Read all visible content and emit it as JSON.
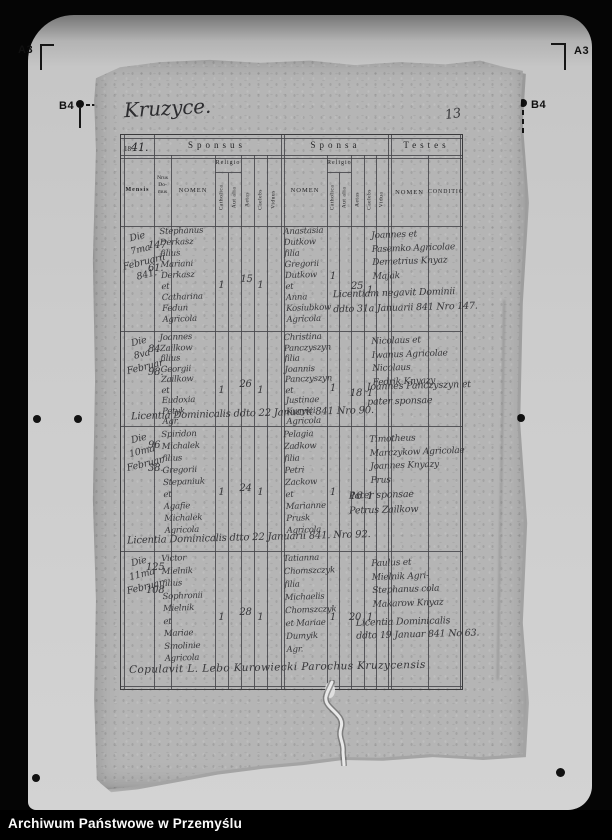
{
  "colors": {
    "background": "#000000",
    "platen": "#c9c9c9",
    "paper": "#b5b5b5",
    "ink": "#37373a",
    "caption_text": "#fbfbfb"
  },
  "fiducials": {
    "a3_left": "A3",
    "a3_right": "A3",
    "b4_left": "B4",
    "b4_right": "B4"
  },
  "caption": "Archiwum Państwowe w Przemyślu",
  "page": {
    "title_script": "Kruzyce.",
    "page_number": "13",
    "year_printed": "18",
    "year_hand": "41.",
    "header": {
      "sponsus": "Sponsus",
      "sponsa": "Sponsa",
      "testes": "Testes",
      "mensis": "Mensis",
      "nrus": [
        "Nrus",
        "Do-",
        "mus"
      ],
      "nomen": "NOMEN",
      "religio": "Religio",
      "catholica": "Catholica",
      "aut_alia": "Aut alia",
      "aetas": "Aetas",
      "caelebs": "Caelebs",
      "viduus": "Viduus",
      "vidua": "Vidua",
      "conditio": "CONDITIO"
    },
    "entries": [
      {
        "mensis": [
          "Die",
          "7ma",
          "Februarii",
          "841."
        ],
        "nrus": [
          "147",
          "61."
        ],
        "sponsus_nomen": [
          "Stephanus",
          "Derkasz",
          "filius",
          "Mariani",
          "Derkasz",
          "et",
          "Catharina",
          "Fedun",
          "Agricola"
        ],
        "sponsus_catholica": "1",
        "sponsus_aetas": "15",
        "sponsus_caelebs": "1",
        "sponsa_nomen": [
          "Anastasia",
          "Dutkow",
          "filia",
          "Gregorii",
          "Dutkow",
          "et",
          "Anna",
          "Kosiubkow",
          "Agricola"
        ],
        "sponsa_catholica": "1",
        "sponsa_aetas": "25",
        "sponsa_caelebs": "1",
        "testes": [
          "Joannes et",
          "Pasemko Agricolae",
          "Demetrius Knyaz",
          "Majak"
        ],
        "note_mid": [
          "Licentiam negavit Dominii",
          "ddto 31a Januarii 841 Nro 147."
        ]
      },
      {
        "mensis": [
          "Die",
          "8va",
          "Februar"
        ],
        "nrus": [
          "84",
          "98."
        ],
        "sponsus_nomen": [
          "Joannes",
          "Zailkow",
          "filius",
          "Georgii",
          "Zailkow",
          "et",
          "Eudoxia",
          "Petyk",
          "Agr."
        ],
        "sponsus_catholica": "1",
        "sponsus_aetas": "26",
        "sponsus_caelebs": "1",
        "sponsa_nomen": [
          "Christina",
          "Panczyszyn",
          "filia",
          "Joannis",
          "Panczyszyn",
          "et",
          "Justinae",
          "Kuryici",
          "Agricola"
        ],
        "sponsa_catholica": "1",
        "sponsa_aetas": "18",
        "sponsa_caelebs": "1",
        "testes": [
          "Nicolaus et",
          "Iwanus Agricolae",
          "Nicolaus",
          "Fedrik Knyazy"
        ],
        "note_mid": [
          "Joannes Panczyszyn et",
          "pater sponsae"
        ],
        "note_bottom": "Licentia Dominicalis ddto 22 Januarii 841 Nro 90."
      },
      {
        "mensis": [
          "Die",
          "10ma",
          "Februar"
        ],
        "nrus": [
          "96",
          "38."
        ],
        "sponsus_nomen": [
          "Spiridon",
          "Michalek",
          "filius",
          "Gregorii",
          "Stepaniuk",
          "et",
          "Agafie",
          "Michalek",
          "Agricola"
        ],
        "sponsus_catholica": "1",
        "sponsus_aetas": "24",
        "sponsus_caelebs": "1",
        "sponsa_nomen": [
          "Pelagia",
          "Zadkow",
          "filia",
          "Petri",
          "Zackow",
          "et",
          "Marianne",
          "Prusk",
          "Agricola"
        ],
        "sponsa_catholica": "1",
        "sponsa_aetas": "16",
        "sponsa_caelebs": "1",
        "testes": [
          "Timotheus",
          "Marczykow Agricolae",
          "Joannes Knyazy",
          "Prus"
        ],
        "note_mid": [
          "Pater sponsae",
          "Petrus Zailkow"
        ],
        "note_bottom": "Licentia Dominicalis dtto 22 Januarii 841. Nro 92."
      },
      {
        "mensis": [
          "Die",
          "11ma",
          "Februar"
        ],
        "nrus": [
          "125",
          "108"
        ],
        "sponsus_nomen": [
          "Victor",
          "Mielnik",
          "filius",
          "Sophronii",
          "Mielnik",
          "et",
          "Mariae",
          "Smolinie",
          "Agricola"
        ],
        "sponsus_catholica": "1",
        "sponsus_aetas": "28",
        "sponsus_caelebs": "1",
        "sponsa_nomen": [
          "Tatianna",
          "Chomszczyk",
          "filia",
          "Michaelis",
          "Chomszczyk",
          "et Mariae",
          "Dumyik",
          "Agr."
        ],
        "sponsa_catholica": "1",
        "sponsa_aetas": "20",
        "sponsa_caelebs": "1",
        "testes": [
          "Paulus et",
          "Mielnik Agri-",
          "Stephanus cola",
          "Makarow Knyaz"
        ],
        "note_mid": [
          "Licentia Dominicalis",
          "ddto 19 Januar 841 No 63."
        ]
      }
    ],
    "footer_line": "Copulavit L. Lebo Kurowiecki Parochus Kruzycensis"
  }
}
